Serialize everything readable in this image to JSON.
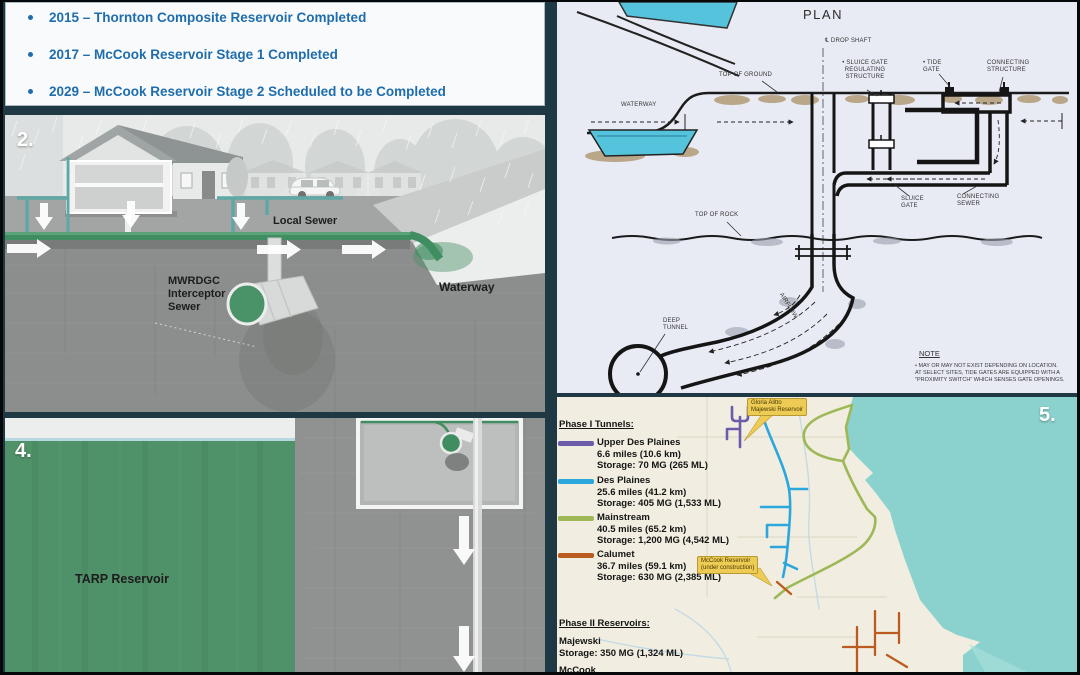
{
  "timeline": {
    "items": [
      "2015 – Thornton Composite Reservoir Completed",
      "2017 – McCook Reservoir Stage 1 Completed",
      "2029 – McCook Reservoir Stage 2 Scheduled to be Completed"
    ]
  },
  "interceptor_diagram": {
    "number": "2.",
    "local_sewer": "Local Sewer",
    "interceptor": "MWRDGC\nInterceptor\nSewer",
    "waterway": "Waterway"
  },
  "plan_diagram": {
    "title": "PLAN",
    "drop_shaft": "℄ DROP SHAFT",
    "top_of_ground": "TOP OF GROUND",
    "waterway": "WATERWAY",
    "sluice_gate_regulating": "• SLUICE GATE\nREGULATING\nSTRUCTURE",
    "tide_gate": "• TIDE\nGATE",
    "connecting_structure": "CONNECTING\nSTRUCTURE",
    "top_of_rock": "TOP OF ROCK",
    "sluice_gate": "SLUICE\nGATE",
    "connecting_sewer": "CONNECTING\nSEWER",
    "deep_tunnel": "DEEP\nTUNNEL",
    "airflow": "AIRFLOW",
    "note_title": "NOTE",
    "note_text": "• MAY OR MAY NOT EXIST DEPENDING ON LOCATION.\nAT SELECT SITES, TIDE GATES ARE EQUIPPED WITH A\n\"PROXIMITY SWITCH\" WHICH SENSES GATE OPENINGS."
  },
  "reservoir_diagram": {
    "number": "4.",
    "label": "TARP Reservoir"
  },
  "map": {
    "number": "5.",
    "phase1_title": "Phase I Tunnels:",
    "tunnels": [
      {
        "name": "Upper Des Plaines",
        "length": "6.6 miles (10.6 km)",
        "storage": "Storage: 70 MG (265 ML)",
        "color": "#6b5ba9"
      },
      {
        "name": "Des Plaines",
        "length": "25.6 miles (41.2 km)",
        "storage": "Storage: 405 MG (1,533 ML)",
        "color": "#2ba7de"
      },
      {
        "name": "Mainstream",
        "length": "40.5 miles (65.2 km)",
        "storage": "Storage: 1,200 MG (4,542 ML)",
        "color": "#9db855"
      },
      {
        "name": "Calumet",
        "length": "36.7 miles (59.1 km)",
        "storage": "Storage: 630 MG (2,385 ML)",
        "color": "#bc5b1f"
      }
    ],
    "phase2_title": "Phase II Reservoirs:",
    "reservoirs": [
      {
        "name": "Majewski",
        "storage": "Storage: 350 MG (1,324 ML)"
      },
      {
        "name": "McCook"
      }
    ],
    "callout_majewski": "Gloria Alitto\nMajewski Reservoir",
    "callout_mccook": "McCook Reservoir\n(under construction)"
  },
  "colors": {
    "slide_background": "#1e3844",
    "timeline_text": "#1f6dad",
    "reservoir_green": "#4f9168",
    "sewer_green": "#3f8d60",
    "plan_water": "#56c3dd",
    "map_land": "#f1eee1",
    "map_lake": "#8bd2cf",
    "callout_yellow": "#eecb55"
  }
}
